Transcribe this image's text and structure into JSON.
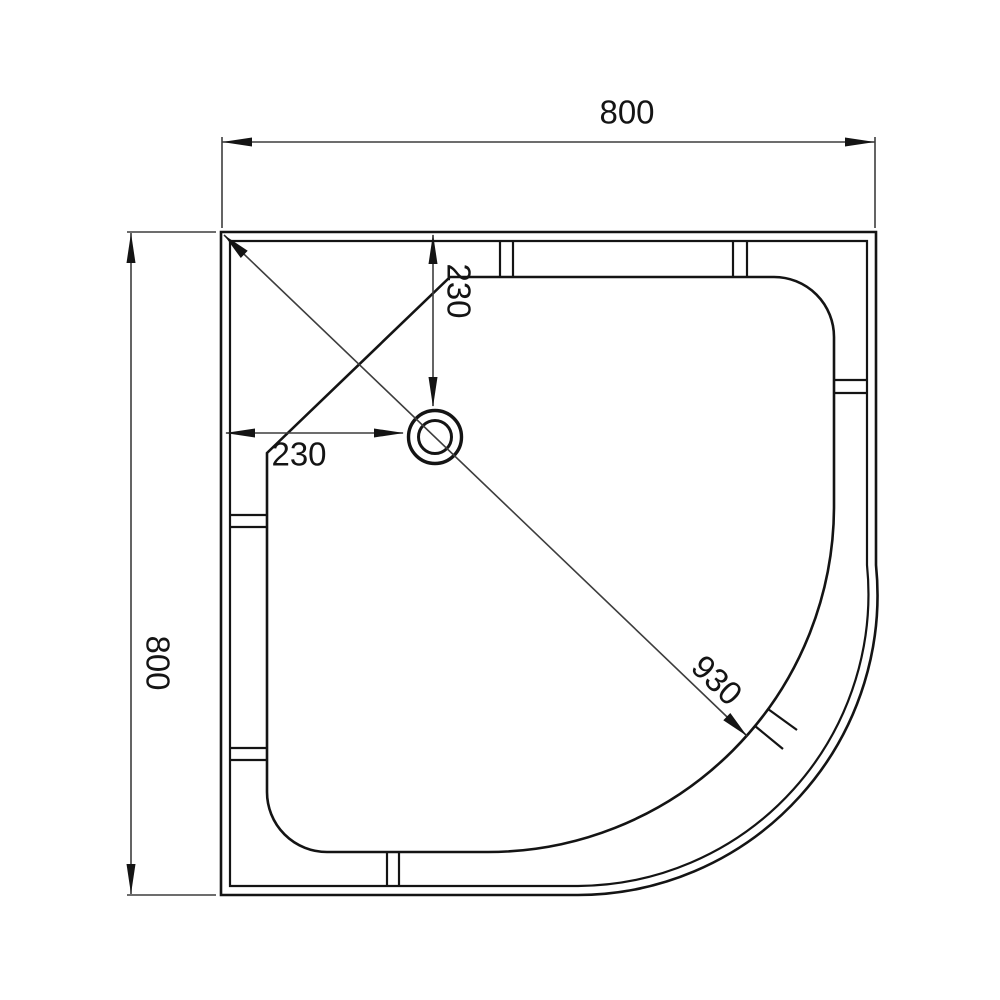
{
  "drawing": {
    "product": "quadrant-shower-tray-plan-view",
    "background_color": "#ffffff",
    "line_color": "#141414",
    "dimensions": {
      "top_width": "800",
      "left_depth": "800",
      "drain_from_top": "230",
      "drain_from_left": "230",
      "diagonal": "930"
    }
  }
}
